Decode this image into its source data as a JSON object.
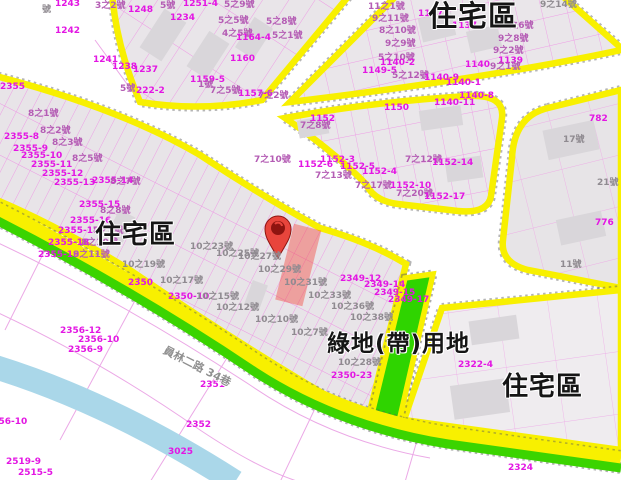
{
  "map": {
    "type": "urban-zoning-cadastral-map",
    "colors": {
      "road_border_yellow": "#f8f000",
      "green_belt": "#2fd400",
      "parcel_line_magenta": "#ef82e4",
      "water_blue": "#aad7e9",
      "block_fill": "#e9e5e9",
      "highlight_red": "#f44336",
      "pin_red": "#e8453c"
    },
    "road_label": {
      "text": "員林二路 34巷"
    },
    "zone_labels": [
      {
        "text": "住宅區",
        "x": 428,
        "y": 2,
        "size": 29
      },
      {
        "text": "住宅區",
        "x": 95,
        "y": 222,
        "size": 26
      },
      {
        "text": "住宅區",
        "x": 502,
        "y": 374,
        "size": 26
      },
      {
        "text": "綠地(帶)用地",
        "x": 327,
        "y": 333,
        "size": 23
      }
    ],
    "marker": {
      "name": "location-pin",
      "tip_x": 278,
      "tip_y": 258
    },
    "parcel_labels": [
      {
        "t": "號",
        "x": 42,
        "y": 6,
        "c": "g"
      },
      {
        "t": "1243",
        "x": 55,
        "y": 0,
        "c": "m"
      },
      {
        "t": "3之2號",
        "x": 95,
        "y": 2,
        "c": "p"
      },
      {
        "t": "1248",
        "x": 128,
        "y": 6,
        "c": "m"
      },
      {
        "t": "5號",
        "x": 160,
        "y": 2,
        "c": "p"
      },
      {
        "t": "1234",
        "x": 170,
        "y": 14,
        "c": "m"
      },
      {
        "t": "1242",
        "x": 55,
        "y": 27,
        "c": "m"
      },
      {
        "t": "1241",
        "x": 93,
        "y": 56,
        "c": "m"
      },
      {
        "t": "1238",
        "x": 112,
        "y": 63,
        "c": "m"
      },
      {
        "t": "1237",
        "x": 133,
        "y": 66,
        "c": "m"
      },
      {
        "t": "5號",
        "x": 120,
        "y": 85,
        "c": "p"
      },
      {
        "t": "222-2",
        "x": 136,
        "y": 87,
        "c": "m"
      },
      {
        "t": "1251-4",
        "x": 183,
        "y": 0,
        "c": "m"
      },
      {
        "t": "5之9號",
        "x": 224,
        "y": 1,
        "c": "p"
      },
      {
        "t": "5之5號",
        "x": 218,
        "y": 17,
        "c": "p"
      },
      {
        "t": "5之8號",
        "x": 266,
        "y": 18,
        "c": "p"
      },
      {
        "t": "4之5號",
        "x": 222,
        "y": 30,
        "c": "p"
      },
      {
        "t": "1164-4",
        "x": 236,
        "y": 34,
        "c": "m"
      },
      {
        "t": "5之1號",
        "x": 272,
        "y": 32,
        "c": "p"
      },
      {
        "t": "1160",
        "x": 230,
        "y": 55,
        "c": "m"
      },
      {
        "t": "1159-5",
        "x": 190,
        "y": 76,
        "c": "m"
      },
      {
        "t": "1號",
        "x": 198,
        "y": 81,
        "c": "p"
      },
      {
        "t": "7之5號",
        "x": 210,
        "y": 87,
        "c": "p"
      },
      {
        "t": "1157-6",
        "x": 238,
        "y": 90,
        "c": "m"
      },
      {
        "t": "7之2號",
        "x": 258,
        "y": 92,
        "c": "p"
      },
      {
        "t": "11之1號",
        "x": 368,
        "y": 3,
        "c": "p"
      },
      {
        "t": "9之11號",
        "x": 372,
        "y": 15,
        "c": "p"
      },
      {
        "t": "8之10號",
        "x": 379,
        "y": 27,
        "c": "p"
      },
      {
        "t": "9之9號",
        "x": 385,
        "y": 40,
        "c": "p"
      },
      {
        "t": "5之10號",
        "x": 378,
        "y": 54,
        "c": "p"
      },
      {
        "t": "1149-5",
        "x": 362,
        "y": 67,
        "c": "m"
      },
      {
        "t": "1147",
        "x": 418,
        "y": 10,
        "c": "m"
      },
      {
        "t": "9之14號",
        "x": 540,
        "y": 1,
        "c": "g"
      },
      {
        "t": "1137",
        "x": 452,
        "y": 22,
        "c": "m"
      },
      {
        "t": "9之6號",
        "x": 503,
        "y": 22,
        "c": "p"
      },
      {
        "t": "9之8號",
        "x": 498,
        "y": 35,
        "c": "p"
      },
      {
        "t": "9之2號",
        "x": 493,
        "y": 47,
        "c": "p"
      },
      {
        "t": "1139",
        "x": 498,
        "y": 57,
        "c": "m"
      },
      {
        "t": "1140",
        "x": 465,
        "y": 61,
        "c": "m"
      },
      {
        "t": "9之1號",
        "x": 490,
        "y": 63,
        "c": "p"
      },
      {
        "t": "1140-2",
        "x": 380,
        "y": 59,
        "c": "m"
      },
      {
        "t": "5之12號",
        "x": 392,
        "y": 72,
        "c": "p"
      },
      {
        "t": "1140-9",
        "x": 424,
        "y": 74,
        "c": "m"
      },
      {
        "t": "1140-1",
        "x": 446,
        "y": 79,
        "c": "m"
      },
      {
        "t": "1140-8",
        "x": 459,
        "y": 92,
        "c": "m"
      },
      {
        "t": "1140-11",
        "x": 434,
        "y": 99,
        "c": "m"
      },
      {
        "t": "782",
        "x": 589,
        "y": 115,
        "c": "m"
      },
      {
        "t": "17號",
        "x": 563,
        "y": 136,
        "c": "g"
      },
      {
        "t": "21號",
        "x": 597,
        "y": 179,
        "c": "g"
      },
      {
        "t": "776",
        "x": 595,
        "y": 219,
        "c": "m"
      },
      {
        "t": "11號",
        "x": 560,
        "y": 261,
        "c": "g"
      },
      {
        "t": "1150",
        "x": 384,
        "y": 104,
        "c": "m"
      },
      {
        "t": "1152",
        "x": 310,
        "y": 115,
        "c": "m"
      },
      {
        "t": "7之8號",
        "x": 300,
        "y": 122,
        "c": "p"
      },
      {
        "t": "7之10號",
        "x": 254,
        "y": 156,
        "c": "p"
      },
      {
        "t": "1152-6",
        "x": 298,
        "y": 161,
        "c": "m"
      },
      {
        "t": "1152-3",
        "x": 320,
        "y": 156,
        "c": "m"
      },
      {
        "t": "1152-5",
        "x": 340,
        "y": 163,
        "c": "m"
      },
      {
        "t": "1152-4",
        "x": 362,
        "y": 168,
        "c": "m"
      },
      {
        "t": "7之13號",
        "x": 315,
        "y": 172,
        "c": "p"
      },
      {
        "t": "7之12號",
        "x": 405,
        "y": 156,
        "c": "p"
      },
      {
        "t": "1152-14",
        "x": 432,
        "y": 159,
        "c": "m"
      },
      {
        "t": "7之17號",
        "x": 355,
        "y": 182,
        "c": "p"
      },
      {
        "t": "1152-10",
        "x": 390,
        "y": 182,
        "c": "m"
      },
      {
        "t": "7之20號",
        "x": 396,
        "y": 190,
        "c": "p"
      },
      {
        "t": "1152-17",
        "x": 424,
        "y": 193,
        "c": "m"
      },
      {
        "t": "2355",
        "x": 0,
        "y": 83,
        "c": "m"
      },
      {
        "t": "8之1號",
        "x": 28,
        "y": 110,
        "c": "p"
      },
      {
        "t": "2355-8",
        "x": 4,
        "y": 133,
        "c": "m"
      },
      {
        "t": "8之2號",
        "x": 40,
        "y": 127,
        "c": "p"
      },
      {
        "t": "2355-9",
        "x": 13,
        "y": 145,
        "c": "m"
      },
      {
        "t": "8之3號",
        "x": 52,
        "y": 139,
        "c": "p"
      },
      {
        "t": "2355-10",
        "x": 21,
        "y": 152,
        "c": "m"
      },
      {
        "t": "2355-11",
        "x": 31,
        "y": 161,
        "c": "m"
      },
      {
        "t": "8之5號",
        "x": 72,
        "y": 155,
        "c": "p"
      },
      {
        "t": "2355-12",
        "x": 42,
        "y": 170,
        "c": "m"
      },
      {
        "t": "2355-13",
        "x": 54,
        "y": 179,
        "c": "m"
      },
      {
        "t": "2355-14",
        "x": 92,
        "y": 177,
        "c": "m"
      },
      {
        "t": "8之7號",
        "x": 110,
        "y": 178,
        "c": "p"
      },
      {
        "t": "2355-15",
        "x": 79,
        "y": 201,
        "c": "m"
      },
      {
        "t": "8之8號",
        "x": 100,
        "y": 207,
        "c": "p"
      },
      {
        "t": "2355-16",
        "x": 70,
        "y": 217,
        "c": "m"
      },
      {
        "t": "2355-17",
        "x": 58,
        "y": 227,
        "c": "m"
      },
      {
        "t": "8之9號",
        "x": 93,
        "y": 227,
        "c": "p"
      },
      {
        "t": "2355-18",
        "x": 48,
        "y": 239,
        "c": "m"
      },
      {
        "t": "8之10號",
        "x": 81,
        "y": 239,
        "c": "p"
      },
      {
        "t": "2355-19",
        "x": 38,
        "y": 251,
        "c": "m"
      },
      {
        "t": "8之11號",
        "x": 73,
        "y": 251,
        "c": "p"
      },
      {
        "t": "10之19號",
        "x": 122,
        "y": 261,
        "c": "g"
      },
      {
        "t": "2350",
        "x": 128,
        "y": 279,
        "c": "m"
      },
      {
        "t": "10之17號",
        "x": 160,
        "y": 277,
        "c": "g"
      },
      {
        "t": "2350-10",
        "x": 168,
        "y": 293,
        "c": "m"
      },
      {
        "t": "10之15號",
        "x": 196,
        "y": 293,
        "c": "g"
      },
      {
        "t": "10之12號",
        "x": 216,
        "y": 304,
        "c": "g"
      },
      {
        "t": "10之10號",
        "x": 255,
        "y": 316,
        "c": "g"
      },
      {
        "t": "10之7號",
        "x": 291,
        "y": 329,
        "c": "g"
      },
      {
        "t": "10之23號",
        "x": 190,
        "y": 243,
        "c": "g"
      },
      {
        "t": "10之25號",
        "x": 216,
        "y": 250,
        "c": "g"
      },
      {
        "t": "10之27號",
        "x": 238,
        "y": 253,
        "c": "g"
      },
      {
        "t": "10之29號",
        "x": 258,
        "y": 266,
        "c": "g"
      },
      {
        "t": "10之31號",
        "x": 284,
        "y": 279,
        "c": "g"
      },
      {
        "t": "10之33號",
        "x": 308,
        "y": 292,
        "c": "g"
      },
      {
        "t": "10之36號",
        "x": 331,
        "y": 303,
        "c": "g"
      },
      {
        "t": "10之38號",
        "x": 350,
        "y": 314,
        "c": "g"
      },
      {
        "t": "2349-12",
        "x": 340,
        "y": 275,
        "c": "m"
      },
      {
        "t": "2349-14",
        "x": 364,
        "y": 281,
        "c": "m"
      },
      {
        "t": "2349-15",
        "x": 374,
        "y": 289,
        "c": "m"
      },
      {
        "t": "2349-17",
        "x": 388,
        "y": 296,
        "c": "m"
      },
      {
        "t": "10之28號",
        "x": 338,
        "y": 359,
        "c": "g"
      },
      {
        "t": "2350-23",
        "x": 331,
        "y": 372,
        "c": "m"
      },
      {
        "t": "2322-4",
        "x": 458,
        "y": 361,
        "c": "m"
      },
      {
        "t": "2356-12",
        "x": 60,
        "y": 327,
        "c": "m"
      },
      {
        "t": "2356-10",
        "x": 78,
        "y": 336,
        "c": "m"
      },
      {
        "t": "2356-9",
        "x": 68,
        "y": 346,
        "c": "m"
      },
      {
        "t": "2356-10",
        "x": -14,
        "y": 418,
        "c": "m"
      },
      {
        "t": "2351",
        "x": 200,
        "y": 381,
        "c": "m"
      },
      {
        "t": "2352",
        "x": 186,
        "y": 421,
        "c": "m"
      },
      {
        "t": "3025",
        "x": 168,
        "y": 448,
        "c": "m"
      },
      {
        "t": "2519-9",
        "x": 6,
        "y": 458,
        "c": "m"
      },
      {
        "t": "2515-5",
        "x": 18,
        "y": 469,
        "c": "m"
      },
      {
        "t": "2324",
        "x": 508,
        "y": 464,
        "c": "m"
      }
    ]
  }
}
